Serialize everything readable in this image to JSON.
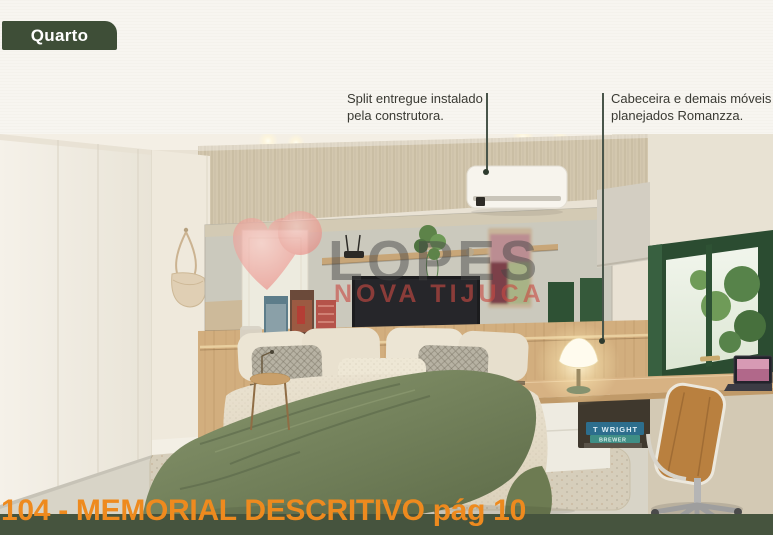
{
  "header": {
    "badge": "Quarto"
  },
  "annotations": [
    {
      "id": "split-ac",
      "text": "Split entregue instalado\npela construtora."
    },
    {
      "id": "headboard-furniture",
      "text": "Cabeceira e demais móveis\nplanejados Romanzza."
    }
  ],
  "watermark": {
    "brand": "LOPES",
    "subtitle": "NOVA TIJUCA"
  },
  "photo": {
    "book_spines": [
      "T WRIGHT",
      "BREWER"
    ]
  },
  "footer": {
    "title": "104 - MEMORIAL DESCRITIVO pág 10"
  },
  "colors": {
    "badge_green": "#3e4e37",
    "footer_strip_green": "#46543e",
    "footer_orange": "#ee8a1e",
    "watermark_red": "#c94b43",
    "watermark_pink": "#ea8781",
    "callout_line": "#49554a",
    "window_green": "#2b4c31",
    "blanket_green": "#7c8a61"
  }
}
